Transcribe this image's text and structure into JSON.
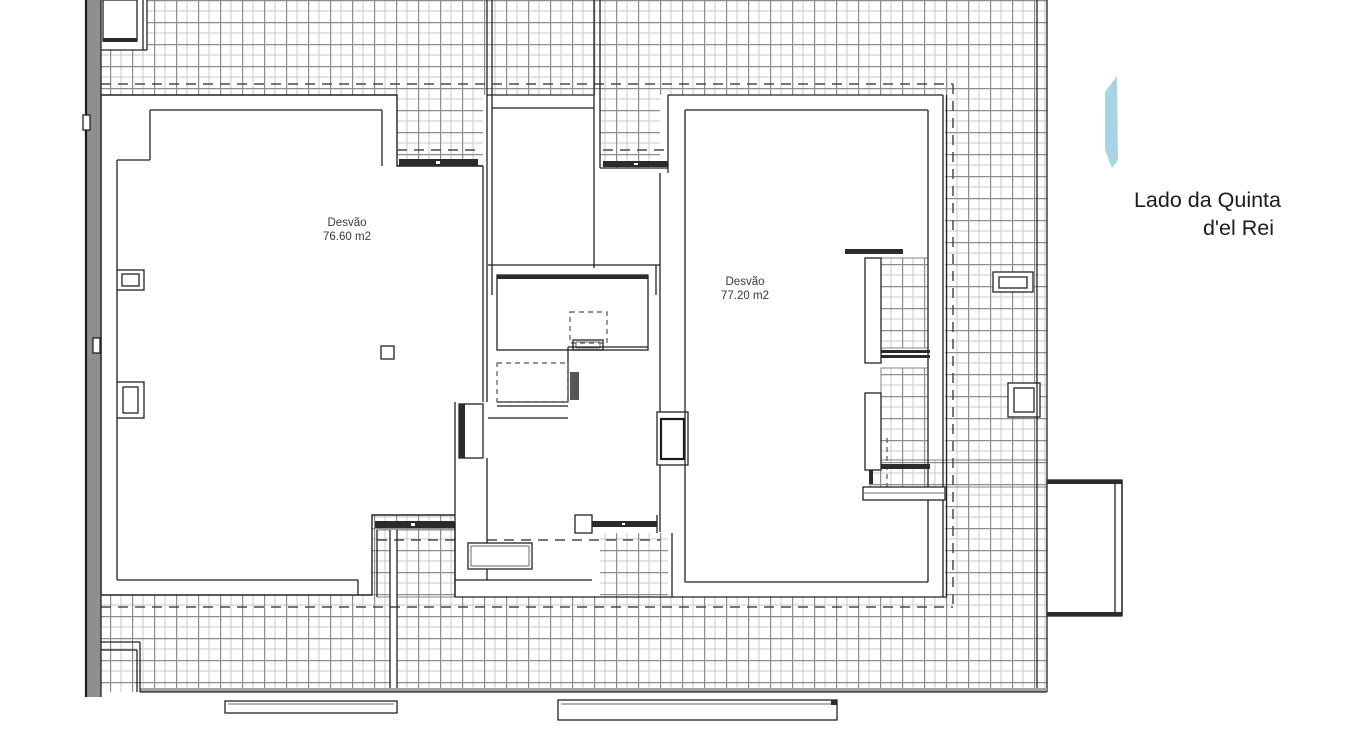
{
  "plan": {
    "type": "architectural-floor-plan",
    "rooms": [
      {
        "name": "Desvão",
        "area": "76.60 m2"
      },
      {
        "name": "Desvão",
        "area": "77.20 m2"
      }
    ],
    "side_label": {
      "line1": "Lado da Quinta",
      "line2": "d'el Rei"
    }
  },
  "colors": {
    "accent_blue": "#a9d4e6",
    "wall": "#222222",
    "dashed_line": "#4a4a4a",
    "hatch_minor": "#c8c8c8",
    "hatch_major": "#8d8d8d",
    "neighbor_wall_fill": "#8f8f8f"
  }
}
